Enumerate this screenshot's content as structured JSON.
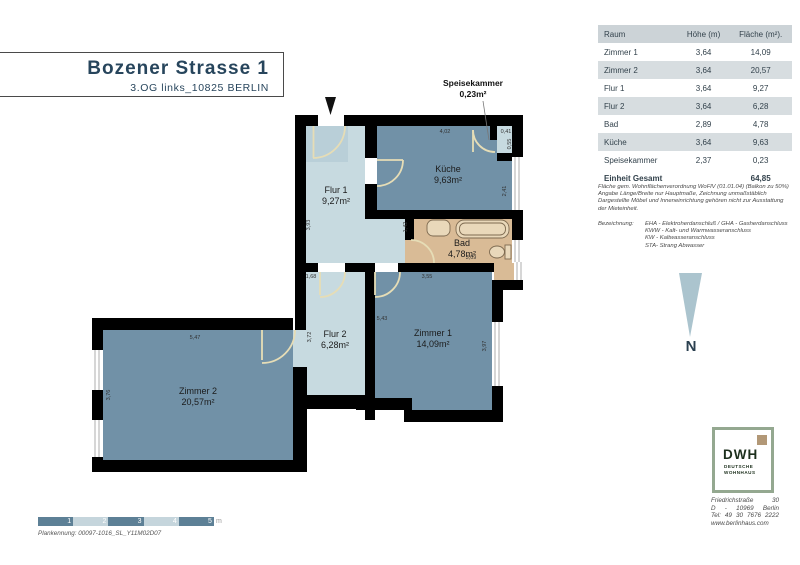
{
  "title": {
    "main": "Bozener Strasse 1",
    "sub": "3.OG links_10825 BERLIN"
  },
  "table": {
    "headers": {
      "raum": "Raum",
      "hoehe": "Höhe (m)",
      "flaeche": "Fläche (m²)."
    },
    "rows": [
      {
        "raum": "Zimmer 1",
        "hoehe": "3,64",
        "flaeche": "14,09"
      },
      {
        "raum": "Zimmer 2",
        "hoehe": "3,64",
        "flaeche": "20,57"
      },
      {
        "raum": "Flur 1",
        "hoehe": "3,64",
        "flaeche": "9,27"
      },
      {
        "raum": "Flur 2",
        "hoehe": "3,64",
        "flaeche": "6,28"
      },
      {
        "raum": "Bad",
        "hoehe": "2,89",
        "flaeche": "4,78"
      },
      {
        "raum": "Küche",
        "hoehe": "3,64",
        "flaeche": "9,63"
      },
      {
        "raum": "Speisekammer",
        "hoehe": "2,37",
        "flaeche": "0,23"
      },
      {
        "raum": "Einheit Gesamt",
        "hoehe": "",
        "flaeche": "64,85"
      }
    ]
  },
  "notes": {
    "l1": "Fläche gem. Wohnflächenverordnung WoFlV (01.01.04) (Balkon zu 50%)",
    "l2": "Angabe Länge/Breite nur Hauptmaße, Zeichnung unmaßstäblich",
    "l3": "Dargestellte Möbel und Inneneinrichtung gehören nicht zur Ausstattung",
    "l4": "der Mieteinheit."
  },
  "bezeichnung": {
    "label": "Bezeichnung:",
    "i1": "EHA - Elektroherdanschluß / GHA - Gasherdanschluss",
    "i2": "KWW - Kalt- und Warmwasseranschluss",
    "i3": "KW - Kaltwasseranschluss",
    "i4": "STA- Strang Abwasser"
  },
  "rooms": {
    "flur1": {
      "name": "Flur 1",
      "area": "9,27m²"
    },
    "kueche": {
      "name": "Küche",
      "area": "9,63m²"
    },
    "bad": {
      "name": "Bad",
      "area": "4,78m²"
    },
    "flur2": {
      "name": "Flur 2",
      "area": "6,28m²"
    },
    "zimmer1": {
      "name": "Zimmer 1",
      "area": "14,09m²"
    },
    "zimmer2": {
      "name": "Zimmer 2",
      "area": "20,57m²"
    },
    "spk": {
      "name": "Speisekammer",
      "area": "0,23m²"
    }
  },
  "dims": {
    "kueche_top": "4,02",
    "spk_w": "0,41",
    "spk_h": "0,55",
    "kueche_right": "2,41",
    "flur1_left": "3,93",
    "bad_left": "1,42",
    "bad_bottom": "3,09",
    "flur2_top": "1,68",
    "zimmer1_top": "3,55",
    "zimmer1_left": "5,43",
    "zimmer1_right": "3,97",
    "flur2_left": "3,72",
    "zimmer2_top": "5,47",
    "zimmer2_left": "3,76"
  },
  "north": {
    "label": "N"
  },
  "logo": {
    "acronym": "DWH",
    "name1": "DEUTSCHE",
    "name2": "WOHNHAUS",
    "addr1": "Friedrichstraße 30",
    "addr2": "D - 10969 Berlin",
    "addr3": "Tel: 49 30 7676 2222",
    "addr4": "www.berlinhaus.com"
  },
  "scalebar": {
    "s1": "1",
    "s2": "2",
    "s3": "3",
    "s4": "4",
    "s5": "5",
    "unit": "m"
  },
  "plan_id": "Plankennung: 00097-1016_SL_Y11M02D07",
  "colors": {
    "wall": "#000000",
    "room_dark": "#7191a7",
    "room_light": "#c7dae0",
    "entry_tint": "#b9cfd8",
    "bad": "#d9bb96",
    "door_arc": "#e6ddb6",
    "scale_dark": "#5d8096",
    "scale_light": "#c5d5dc",
    "navy": "#27455c",
    "logo_green": "#94a890",
    "logo_tan": "#b29877",
    "north_fill": "#abc4ce"
  }
}
